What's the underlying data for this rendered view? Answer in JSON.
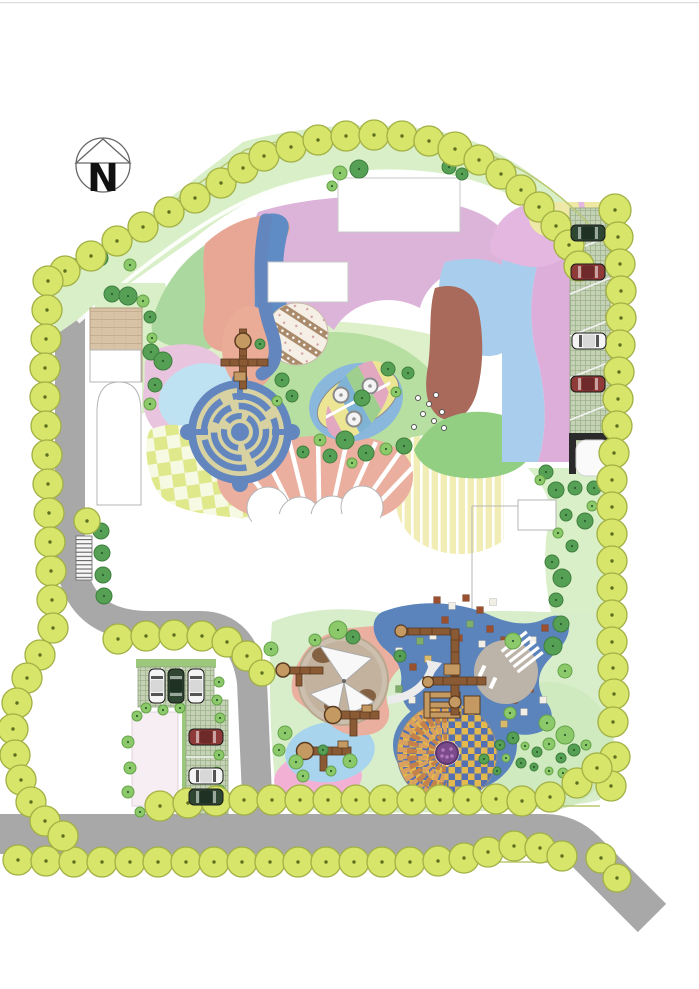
{
  "compass": {
    "label": "N"
  },
  "palette": {
    "pageBg": "#ffffff",
    "topBorder": "#dedede",
    "road": "#a8a8a8",
    "lawnBand": "#d9efc8",
    "lawnBase": "#d8eecb",
    "lawnCircle": "#cfeabf",
    "lawnCircleEdge": "#abc896",
    "lawnMid": "#b7dfa2",
    "lawnDark": "#93cf82",
    "courtyard": "#def0ca",
    "treePerimeter": "#d7e56b",
    "treePerimeterEdge": "#a2b044",
    "treeDot": "#5f6f1f",
    "treeDark": "#55a055",
    "treeDarkEdge": "#3e7e3e",
    "treeLight": "#8bc96a",
    "treeLightEdge": "#65a349",
    "siteLine": "#b9c86d",
    "plaza": "#d8c3a6",
    "plazaLine": "#c2a98a",
    "mauve": "#dcb4da",
    "bandGreen": "#abd89e",
    "bandSalmon": "#e8a795",
    "bandBlue": "#5f8cc4",
    "pinkBlob": "#e9c4de",
    "lightBlue2": "#bfe2f2",
    "lightBlueRight": "#a9cdec",
    "brown": "#a96a5c",
    "mosaicBg": "#f5efe5",
    "mosaicStripe": "#a98a6a",
    "mosaicDot": "#d4a0a0",
    "salmonOval": "#eaab97",
    "salmonFan": "#eaaf9f",
    "mazeBlue": "#6286bd",
    "mazeTan": "#d8d2a2",
    "checkerA": "#dfe88b",
    "checkerB": "#f7fae3",
    "deckBg": "#f2edb4",
    "leafBg": "#8ab8dc",
    "leafYellow": "#ece594",
    "leafPink": "#e2a8c0",
    "leafBlue": "#7fb3d5",
    "leafGreen": "#9fcf8f",
    "sphere": "#f4f4f4",
    "sphereEdge": "#8a8a8a",
    "bandsPink": "#dcaed9",
    "bandsYellow": "#efe8a2",
    "pinkQuarter": "#e3b7df",
    "yellowWedge": "#eee9a6",
    "paver": "#c6d2b6",
    "paverLine": "#9db38c",
    "hedge": "#9cc87c",
    "carEdge": "#1c1c1c",
    "cars": {
      "darkGreen": {
        "body": "#2e4632",
        "roof": "#1f3122",
        "glass": "#9aa89e"
      },
      "darkRed": {
        "body": "#8e3a38",
        "roof": "#6d2a29",
        "glass": "#c9a3a2"
      },
      "white": {
        "body": "#f4f4f4",
        "roof": "#d8d8d8",
        "glass": "#555555"
      }
    },
    "sandRing": "#cdbfae",
    "sandInner": "#c2b29e",
    "sailWhite": "#f8f8f8",
    "sandBrown": "#7a5232",
    "rubberBlue": "#5b84bd",
    "grayCircle": "#bcb4a8",
    "checkGold": "#e3b84d",
    "checkBlue": "#5470b3",
    "fanLight": "#d9a05e",
    "fanDark": "#c4824a",
    "purple": "#7a4a8a",
    "purpleEdge": "#5a3569",
    "purpleDot": "#b07ab8",
    "equipBrown": "#8a5a34",
    "equipTan": "#c49a62",
    "equipEdge": "#5a3a20",
    "pinkSouth": "#f2b0d4",
    "lightBlueSouth": "#a8d4ee",
    "pinkPale": "#f7eef4",
    "outline": "#b5b5b5",
    "offWhite": "#ececec",
    "sqBrown": "#9a4f2e",
    "sqWhite": "#f2efe6",
    "sqGreen": "#7fae6a",
    "sqTan": "#d9b96a",
    "compassStroke": "#666666",
    "compassText": "#111111"
  },
  "trees": {
    "perimeter": [
      [
        65,
        271
      ],
      [
        91,
        256
      ],
      [
        117,
        241
      ],
      [
        143,
        227
      ],
      [
        169,
        212
      ],
      [
        195,
        198
      ],
      [
        221,
        183
      ],
      [
        243,
        168
      ],
      [
        264,
        156
      ],
      [
        291,
        147
      ],
      [
        318,
        140
      ],
      [
        346,
        136
      ],
      [
        374,
        135
      ],
      [
        402,
        136
      ],
      [
        429,
        141
      ],
      [
        455,
        149,
        17
      ],
      [
        479,
        160
      ],
      [
        501,
        174
      ],
      [
        521,
        190
      ],
      [
        539,
        207
      ],
      [
        556,
        226
      ],
      [
        569,
        245
      ],
      [
        579,
        266
      ],
      [
        615,
        210,
        16
      ],
      [
        618,
        237
      ],
      [
        620,
        264
      ],
      [
        621,
        291
      ],
      [
        621,
        318
      ],
      [
        620,
        345
      ],
      [
        619,
        372
      ],
      [
        618,
        399
      ],
      [
        617,
        426
      ],
      [
        614,
        453
      ],
      [
        612,
        480
      ],
      [
        612,
        507
      ],
      [
        612,
        534
      ],
      [
        612,
        561
      ],
      [
        612,
        588
      ],
      [
        612,
        615
      ],
      [
        612,
        642
      ],
      [
        613,
        668
      ],
      [
        614,
        694
      ],
      [
        613,
        722
      ],
      [
        615,
        757
      ],
      [
        611,
        786
      ],
      [
        601,
        858
      ],
      [
        617,
        878,
        14
      ],
      [
        160,
        806
      ],
      [
        188,
        803
      ],
      [
        216,
        801
      ],
      [
        244,
        800
      ],
      [
        272,
        800
      ],
      [
        300,
        800
      ],
      [
        328,
        800
      ],
      [
        356,
        800
      ],
      [
        384,
        800
      ],
      [
        412,
        800
      ],
      [
        440,
        800
      ],
      [
        468,
        800
      ],
      [
        496,
        799
      ],
      [
        522,
        801
      ],
      [
        550,
        797
      ],
      [
        577,
        783
      ],
      [
        597,
        768
      ],
      [
        18,
        860
      ],
      [
        46,
        861
      ],
      [
        74,
        862
      ],
      [
        102,
        862
      ],
      [
        130,
        862
      ],
      [
        158,
        862
      ],
      [
        186,
        862
      ],
      [
        214,
        862
      ],
      [
        242,
        862
      ],
      [
        270,
        862
      ],
      [
        298,
        862
      ],
      [
        326,
        862
      ],
      [
        354,
        862
      ],
      [
        382,
        862
      ],
      [
        410,
        862
      ],
      [
        438,
        861
      ],
      [
        464,
        858
      ],
      [
        488,
        852
      ],
      [
        514,
        846
      ],
      [
        540,
        848
      ],
      [
        562,
        856
      ],
      [
        48,
        281
      ],
      [
        47,
        310
      ],
      [
        46,
        339
      ],
      [
        45,
        368
      ],
      [
        45,
        397
      ],
      [
        46,
        426
      ],
      [
        47,
        455
      ],
      [
        48,
        484
      ],
      [
        49,
        513
      ],
      [
        50,
        542
      ],
      [
        51,
        571
      ],
      [
        52,
        600
      ],
      [
        53,
        628
      ],
      [
        40,
        655
      ],
      [
        27,
        678
      ],
      [
        17,
        703
      ],
      [
        13,
        729
      ],
      [
        15,
        755
      ],
      [
        21,
        780
      ],
      [
        31,
        802
      ],
      [
        45,
        821
      ],
      [
        63,
        836
      ],
      [
        118,
        639
      ],
      [
        146,
        636
      ],
      [
        174,
        635
      ],
      [
        202,
        636
      ],
      [
        227,
        642
      ],
      [
        247,
        656
      ],
      [
        262,
        673,
        13
      ],
      [
        87,
        521,
        13
      ]
    ],
    "inner": [
      [
        100,
        258,
        8,
        "d"
      ],
      [
        84,
        251,
        6,
        "l"
      ],
      [
        115,
        247,
        7,
        "d"
      ],
      [
        72,
        263,
        5,
        "l"
      ],
      [
        130,
        265,
        6,
        "l"
      ],
      [
        340,
        173,
        7,
        "l"
      ],
      [
        359,
        169,
        9,
        "d"
      ],
      [
        449,
        167,
        7,
        "d"
      ],
      [
        462,
        174,
        6,
        "d"
      ],
      [
        332,
        186,
        5,
        "l"
      ],
      [
        112,
        294,
        8,
        "d"
      ],
      [
        128,
        296,
        9,
        "d"
      ],
      [
        143,
        301,
        6,
        "l"
      ],
      [
        150,
        317,
        6,
        "d"
      ],
      [
        152,
        338,
        5,
        "l"
      ],
      [
        151,
        352,
        8,
        "d"
      ],
      [
        163,
        361,
        9,
        "d"
      ],
      [
        155,
        385,
        7,
        "d"
      ],
      [
        150,
        404,
        6,
        "l"
      ],
      [
        282,
        380,
        7,
        "d"
      ],
      [
        292,
        396,
        6,
        "d"
      ],
      [
        277,
        401,
        5,
        "l"
      ],
      [
        260,
        344,
        5,
        "d"
      ],
      [
        388,
        369,
        7,
        "d"
      ],
      [
        408,
        373,
        6,
        "d"
      ],
      [
        362,
        398,
        8,
        "d"
      ],
      [
        396,
        392,
        5,
        "l"
      ],
      [
        345,
        440,
        9,
        "d"
      ],
      [
        330,
        456,
        7,
        "d"
      ],
      [
        303,
        452,
        6,
        "d"
      ],
      [
        366,
        453,
        8,
        "d"
      ],
      [
        386,
        449,
        6,
        "l"
      ],
      [
        404,
        446,
        8,
        "d"
      ],
      [
        320,
        440,
        6,
        "l"
      ],
      [
        352,
        463,
        5,
        "l"
      ],
      [
        546,
        472,
        7,
        "d"
      ],
      [
        556,
        490,
        8,
        "d"
      ],
      [
        575,
        488,
        7,
        "d"
      ],
      [
        594,
        488,
        7,
        "d"
      ],
      [
        566,
        515,
        6,
        "d"
      ],
      [
        585,
        521,
        8,
        "d"
      ],
      [
        558,
        533,
        5,
        "l"
      ],
      [
        572,
        546,
        6,
        "d"
      ],
      [
        552,
        562,
        7,
        "d"
      ],
      [
        562,
        578,
        9,
        "d"
      ],
      [
        556,
        600,
        7,
        "d"
      ],
      [
        561,
        624,
        8,
        "d"
      ],
      [
        540,
        480,
        5,
        "l"
      ],
      [
        592,
        506,
        5,
        "l"
      ],
      [
        101,
        531,
        8,
        "d"
      ],
      [
        102,
        553,
        8,
        "d"
      ],
      [
        103,
        575,
        8,
        "d"
      ],
      [
        104,
        596,
        8,
        "d"
      ],
      [
        338,
        630,
        9,
        "l"
      ],
      [
        353,
        637,
        7,
        "d"
      ],
      [
        271,
        649,
        7,
        "l"
      ],
      [
        400,
        656,
        6,
        "d"
      ],
      [
        315,
        640,
        6,
        "l"
      ],
      [
        513,
        641,
        8,
        "l"
      ],
      [
        553,
        646,
        9,
        "d"
      ],
      [
        565,
        671,
        7,
        "l"
      ],
      [
        510,
        713,
        6,
        "l"
      ],
      [
        547,
        723,
        8,
        "l"
      ],
      [
        285,
        733,
        7,
        "l"
      ],
      [
        296,
        762,
        7,
        "l"
      ],
      [
        279,
        750,
        6,
        "l"
      ],
      [
        323,
        750,
        5,
        "d"
      ],
      [
        350,
        761,
        7,
        "l"
      ],
      [
        331,
        771,
        5,
        "l"
      ],
      [
        303,
        776,
        6,
        "l"
      ],
      [
        565,
        735,
        9,
        "l"
      ],
      [
        500,
        745,
        5,
        "d"
      ],
      [
        513,
        738,
        6,
        "d"
      ],
      [
        525,
        746,
        4,
        "l"
      ],
      [
        537,
        752,
        5,
        "d"
      ],
      [
        549,
        744,
        6,
        "l"
      ],
      [
        506,
        758,
        4,
        "l"
      ],
      [
        521,
        763,
        5,
        "d"
      ],
      [
        534,
        767,
        4,
        "d"
      ],
      [
        561,
        758,
        5,
        "d"
      ],
      [
        574,
        750,
        6,
        "d"
      ],
      [
        586,
        745,
        5,
        "l"
      ],
      [
        549,
        771,
        4,
        "l"
      ],
      [
        563,
        773,
        5,
        "l"
      ],
      [
        497,
        771,
        4,
        "d"
      ],
      [
        484,
        759,
        5,
        "d"
      ],
      [
        146,
        708,
        5,
        "l"
      ],
      [
        163,
        710,
        5,
        "l"
      ],
      [
        180,
        708,
        5,
        "l"
      ],
      [
        137,
        716,
        5,
        "l"
      ],
      [
        128,
        742,
        6,
        "l"
      ],
      [
        130,
        768,
        6,
        "l"
      ],
      [
        128,
        792,
        6,
        "l"
      ],
      [
        140,
        812,
        5,
        "l"
      ],
      [
        219,
        682,
        5,
        "l"
      ],
      [
        217,
        700,
        5,
        "l"
      ],
      [
        220,
        718,
        5,
        "l"
      ],
      [
        218,
        736,
        5,
        "l"
      ],
      [
        219,
        755,
        5,
        "l"
      ],
      [
        217,
        772,
        5,
        "l"
      ],
      [
        220,
        790,
        5,
        "l"
      ]
    ],
    "dots": [
      [
        418,
        398
      ],
      [
        429,
        404
      ],
      [
        423,
        414
      ],
      [
        434,
        421
      ],
      [
        442,
        412
      ],
      [
        414,
        427
      ],
      [
        444,
        428
      ],
      [
        436,
        395
      ]
    ]
  },
  "cars": [
    {
      "x": 588,
      "y": 233,
      "dir": "h",
      "color": "darkGreen"
    },
    {
      "x": 588,
      "y": 272,
      "dir": "h",
      "color": "darkRed"
    },
    {
      "x": 589,
      "y": 341,
      "dir": "h",
      "color": "white"
    },
    {
      "x": 588,
      "y": 384,
      "dir": "h",
      "color": "darkRed"
    },
    {
      "x": 157,
      "y": 686,
      "dir": "v",
      "color": "white"
    },
    {
      "x": 176,
      "y": 686,
      "dir": "v",
      "color": "darkGreen"
    },
    {
      "x": 196,
      "y": 686,
      "dir": "v",
      "color": "white"
    },
    {
      "x": 206,
      "y": 737,
      "dir": "h",
      "color": "darkRed"
    },
    {
      "x": 206,
      "y": 776,
      "dir": "h",
      "color": "white"
    },
    {
      "x": 206,
      "y": 797,
      "dir": "h",
      "color": "darkGreen"
    }
  ],
  "play_squares": [
    [
      437,
      600,
      "br"
    ],
    [
      452,
      606,
      "wh"
    ],
    [
      466,
      598,
      "br"
    ],
    [
      480,
      610,
      "br"
    ],
    [
      493,
      602,
      "wh"
    ],
    [
      445,
      620,
      "br"
    ],
    [
      470,
      624,
      "gr"
    ],
    [
      490,
      629,
      "br"
    ],
    [
      433,
      636,
      "wh"
    ],
    [
      459,
      638,
      "br"
    ],
    [
      482,
      644,
      "wh"
    ],
    [
      504,
      640,
      "br"
    ],
    [
      519,
      650,
      "gr"
    ],
    [
      399,
      651,
      "wh"
    ],
    [
      413,
      667,
      "br"
    ],
    [
      399,
      689,
      "gr"
    ],
    [
      412,
      700,
      "wh"
    ],
    [
      428,
      659,
      "tn"
    ],
    [
      514,
      700,
      "br"
    ],
    [
      524,
      712,
      "wh"
    ],
    [
      431,
      729,
      "br"
    ],
    [
      452,
      736,
      "gr"
    ],
    [
      470,
      740,
      "br"
    ],
    [
      487,
      731,
      "wh"
    ],
    [
      504,
      724,
      "tn"
    ],
    [
      530,
      689,
      "br"
    ],
    [
      543,
      700,
      "wh"
    ],
    [
      420,
      641,
      "gr"
    ],
    [
      533,
      640,
      "wh"
    ],
    [
      545,
      628,
      "br"
    ]
  ]
}
